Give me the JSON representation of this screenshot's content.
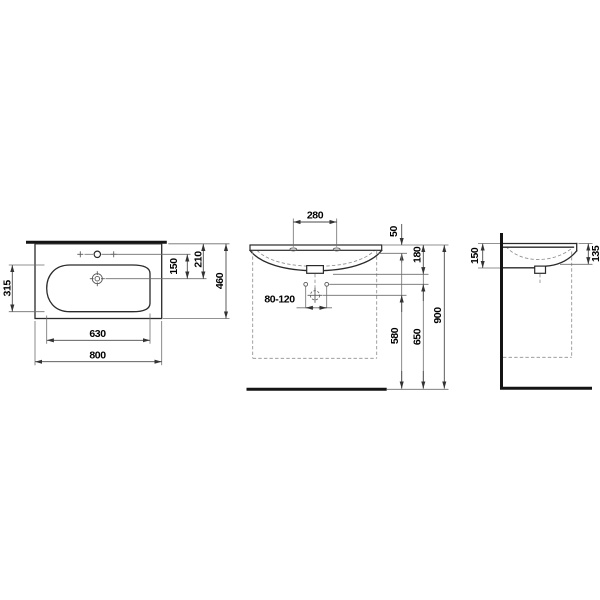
{
  "drawing": {
    "type": "technical dimension drawing",
    "subject": "wall-mounted washbasin, three orthographic views",
    "units": "mm",
    "colors": {
      "object_line": "#2a2a2a",
      "thick_line": "#141414",
      "dimension_line": "#6e6e6e",
      "text": "#000000",
      "background": "#ffffff"
    },
    "views": {
      "plan": {
        "dim_basin_depth": "315",
        "dim_tap_to_drain": "150",
        "dim_front_edge_to_drain": "210",
        "dim_total_depth": "460",
        "dim_basin_width": "630",
        "dim_total_width": "800"
      },
      "front": {
        "dim_tap_hole_spacing": "280",
        "dim_rim_to_apron": "50",
        "dim_rim_to_outlet": "180",
        "dim_trap_offset_range": "80-120",
        "dim_drain_axis_height": "580",
        "dim_fixing_hole_height": "650",
        "dim_rim_height": "900"
      },
      "side": {
        "dim_height_at_wall": "150",
        "dim_height_at_front": "135"
      }
    }
  }
}
